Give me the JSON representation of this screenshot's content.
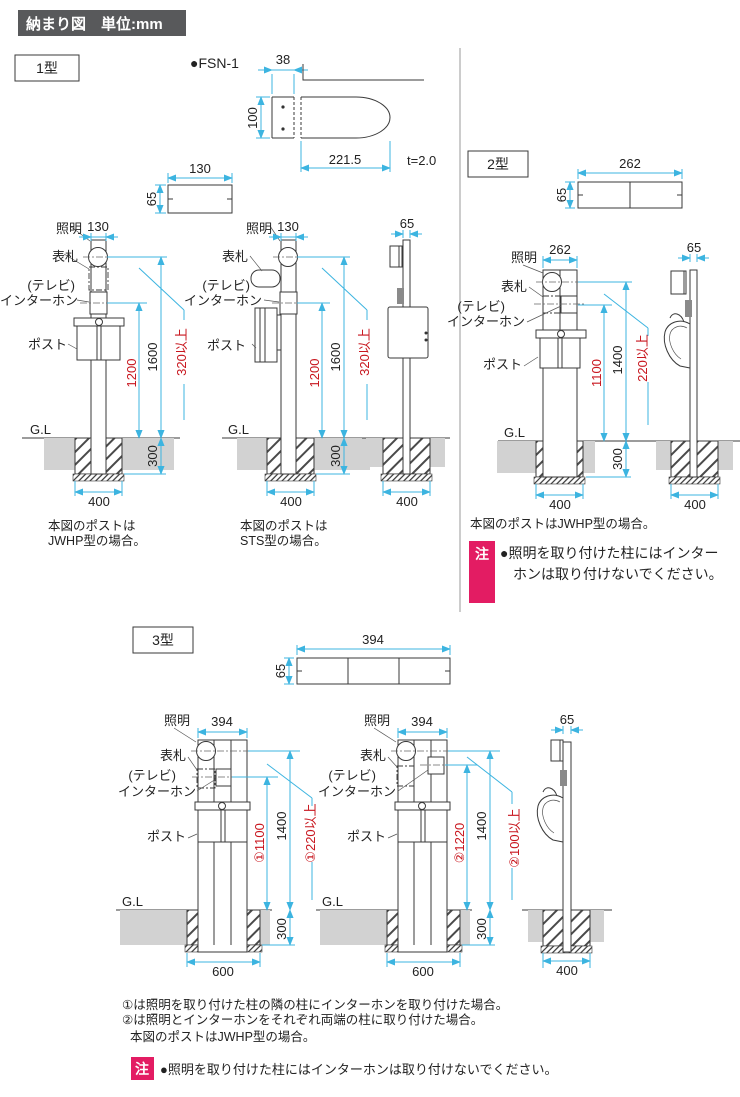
{
  "header": {
    "title": "納まり図　単位:mm"
  },
  "labels": {
    "light": "照明",
    "nameplate": "表札",
    "tv": "(テレビ)",
    "interphone": "インターホン",
    "post": "ポスト",
    "gl": "G.L"
  },
  "type1": {
    "label": "1型",
    "product": "●FSN-1",
    "detail": {
      "w": "38",
      "h": "100",
      "len": "221.5",
      "thick": "t=2.0"
    },
    "topview": {
      "w": "130",
      "d": "65"
    },
    "frontA": {
      "w": "130",
      "h_total": "1600",
      "h_mid": "1200",
      "min": "320以上",
      "depth": "300",
      "footing": "400",
      "note1": "本図のポストは",
      "note2": "JWHP型の場合。"
    },
    "frontB": {
      "w": "130",
      "h_total": "1600",
      "h_mid": "1200",
      "min": "320以上",
      "depth": "300",
      "footing": "400",
      "note1": "本図のポストは",
      "note2": "STS型の場合。"
    },
    "side": {
      "w": "65",
      "footing": "400"
    }
  },
  "type2": {
    "label": "2型",
    "topview": {
      "w": "262",
      "d": "65"
    },
    "front": {
      "w": "262",
      "h_total": "1400",
      "h_mid": "1100",
      "min": "220以上",
      "depth": "300",
      "footing": "400"
    },
    "side": {
      "w": "65",
      "footing": "400"
    },
    "note": "本図のポストはJWHP型の場合。",
    "caution": {
      "tag": "注",
      "line1": "●照明を取り付けた柱にはインター",
      "line2": "ホンは取り付けないでください。"
    }
  },
  "type3": {
    "label": "3型",
    "topview": {
      "w": "394",
      "d": "65"
    },
    "front1": {
      "w": "394",
      "h_total": "1400",
      "h_mid": "①1100",
      "min": "①220以上",
      "depth": "300",
      "footing": "600"
    },
    "front2": {
      "w": "394",
      "h_total": "1400",
      "h_mid": "②1220",
      "min": "②100以上",
      "depth": "300",
      "footing": "600"
    },
    "side": {
      "w": "65",
      "footing": "400"
    },
    "note1": "①は照明を取り付けた柱の隣の柱にインターホンを取り付けた場合。",
    "note2": "②は照明とインターホンをそれぞれ両端の柱に取り付けた場合。",
    "note3": "本図のポストはJWHP型の場合。",
    "caution": {
      "tag": "注",
      "text": "●照明を取り付けた柱にはインターホンは取り付けないでください。"
    }
  },
  "colors": {
    "dimension_line": "#3cb4e0",
    "emphasis_text": "#c8161e",
    "caution_bg": "#e31c63",
    "ground_fill": "#d2d2d2",
    "header_bg": "#58595b"
  }
}
